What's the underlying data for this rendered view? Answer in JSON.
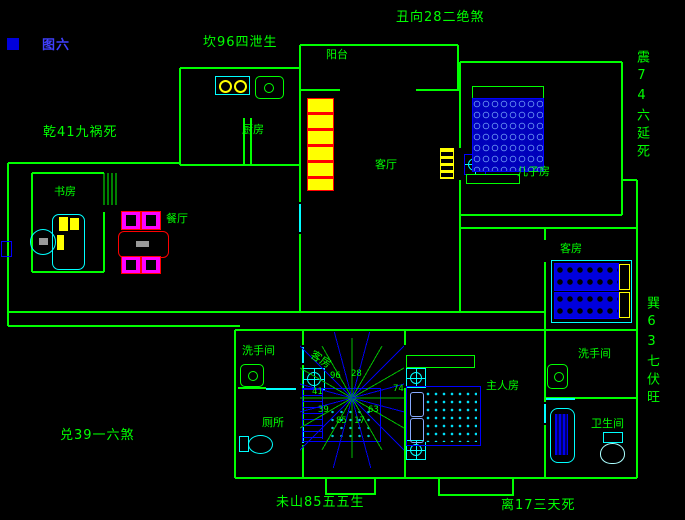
{
  "title": {
    "figure": "图六"
  },
  "perimeter_labels": {
    "top": "丑向28二绝煞",
    "north": "坎96四泄生",
    "northwest": "乾41九祸死",
    "east": "震74六延死",
    "southeast": "巽63七伏旺",
    "west": "兑39一六煞",
    "southwest": "未山85五五生",
    "south": "离17三天死"
  },
  "rooms": {
    "balcony": "阳台",
    "kitchen": "厨房",
    "living_room": "客厅",
    "son_room": "儿子房",
    "study": "书房",
    "dining": "餐厅",
    "guest_room": "客房",
    "washroom_left": "洗手间",
    "toilet_left": "厕所",
    "stair_hall": "客房",
    "master_room": "主人房",
    "washroom_right": "洗手间",
    "bathroom_right": "卫生间"
  },
  "compass": {
    "center": {
      "x": 352,
      "y": 398
    },
    "ray_count": 24,
    "green_ray_radius": 60,
    "blue_ray_radius": 82,
    "numbers": [
      {
        "text": "96",
        "x": 330,
        "y": 371
      },
      {
        "text": "28",
        "x": 351,
        "y": 369
      },
      {
        "text": "74",
        "x": 393,
        "y": 384
      },
      {
        "text": "63",
        "x": 368,
        "y": 405
      },
      {
        "text": "17",
        "x": 354,
        "y": 416
      },
      {
        "text": "85",
        "x": 336,
        "y": 416
      },
      {
        "text": "39",
        "x": 318,
        "y": 405
      },
      {
        "text": "41",
        "x": 312,
        "y": 387
      }
    ]
  },
  "colors": {
    "background": "#000000",
    "wall_green": "#00ff00",
    "fixture_cyan": "#00ffff",
    "furniture_blue": "#0000ff",
    "accent_yellow": "#ffff00",
    "dining_red": "#ff0000",
    "dining_magenta": "#ff00ff",
    "figure_label_blue": "#4040ff"
  },
  "icons": {
    "fan": "ceiling-fan-crosshair-in-box",
    "stove": "two-burner-cooktop",
    "sink": "rounded-basin-with-drain",
    "toilet": "tank-and-bowl",
    "bathtub": "rect-tub",
    "stairs": "stair-flight-with-treads",
    "compass": "24-point-radial-star"
  }
}
